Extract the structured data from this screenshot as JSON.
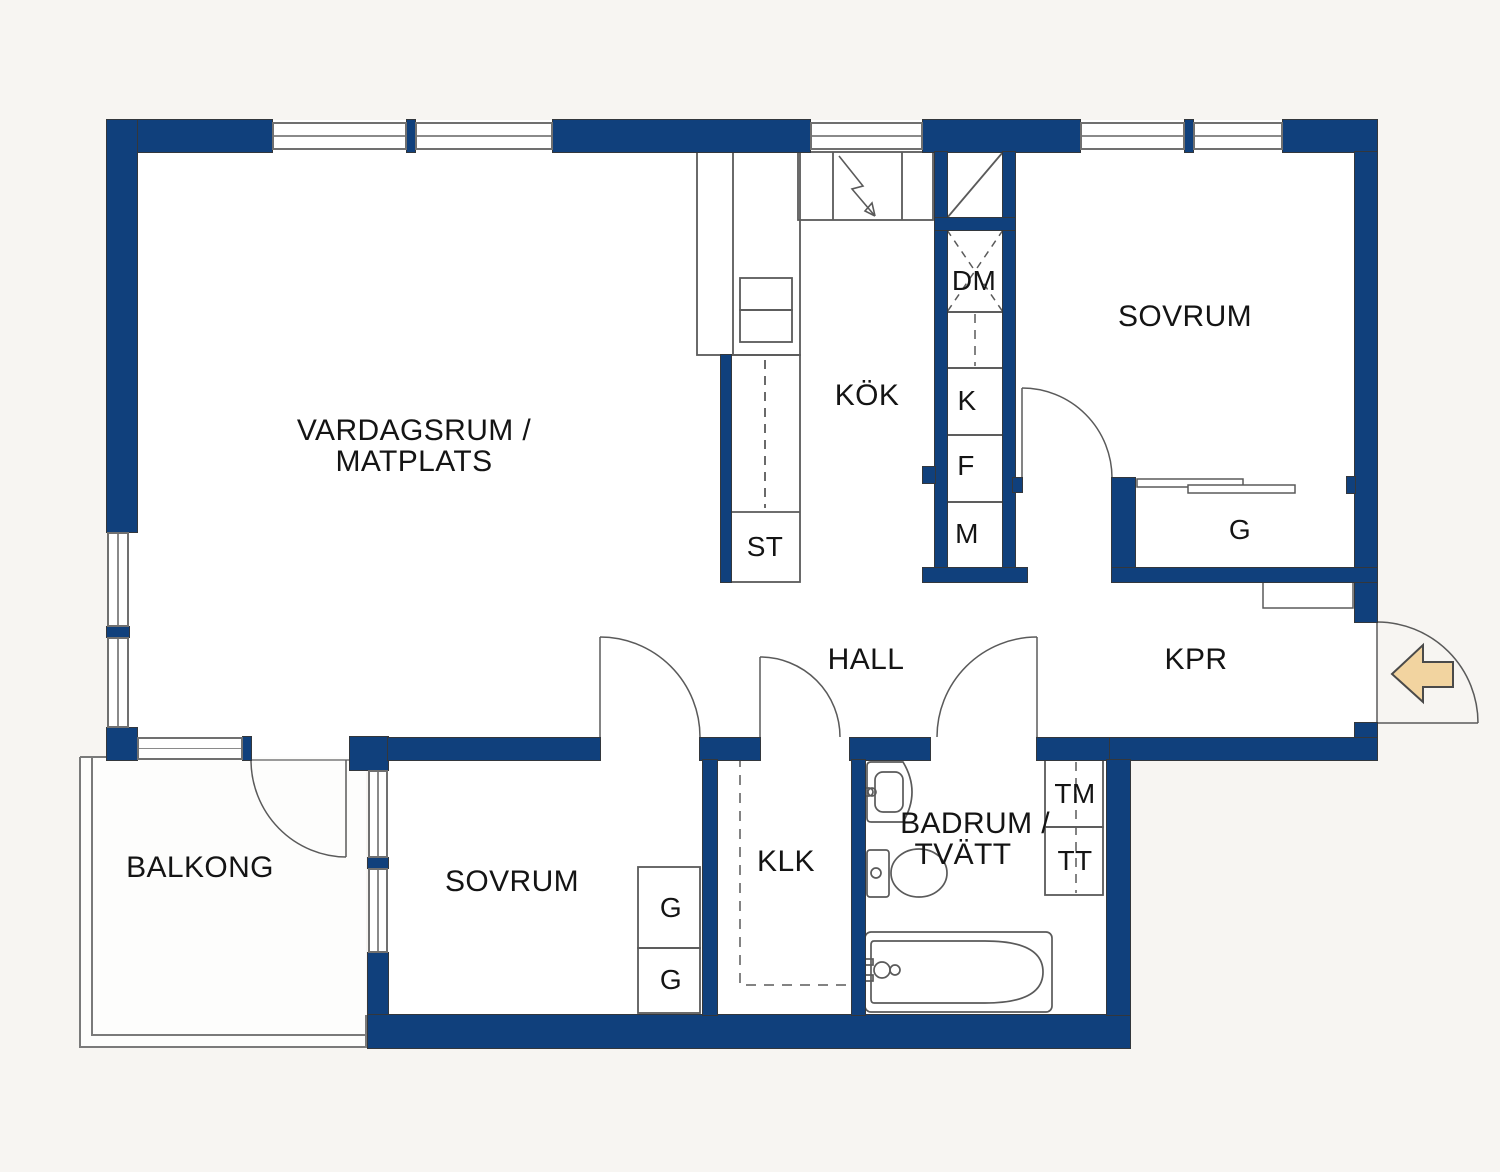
{
  "title": "Apartment floor plan",
  "rooms": {
    "living_line1": "VARDAGSRUM /",
    "living_line2": "MATPLATS",
    "kitchen": "KÖK",
    "bedroom_upper": "SOVRUM",
    "bedroom_lower": "SOVRUM",
    "hall": "HALL",
    "kpr": "KPR",
    "balcony": "BALKONG",
    "walkin_closet": "KLK",
    "bathroom_line1": "BADRUM /",
    "bathroom_line2": "TVÄTT"
  },
  "fixtures": {
    "dishwasher": "DM",
    "fridge": "K",
    "freezer": "F",
    "micro": "M",
    "cleaning_closet": "ST",
    "wardrobe": "G",
    "washing_machine": "TM",
    "tumble_dryer": "TT"
  },
  "icons": {
    "entry_arrow": "entry-direction-arrow",
    "stove": "lightning-stove-symbol",
    "vent": "ventilation-shaft-diagonal",
    "door": "quarter-circle-door-swing"
  },
  "colors": {
    "wall": "#10407C",
    "line": "#5a5a5a",
    "text": "#141414",
    "bg": "#f7f5f2",
    "arrow": "#f2d4a0"
  }
}
